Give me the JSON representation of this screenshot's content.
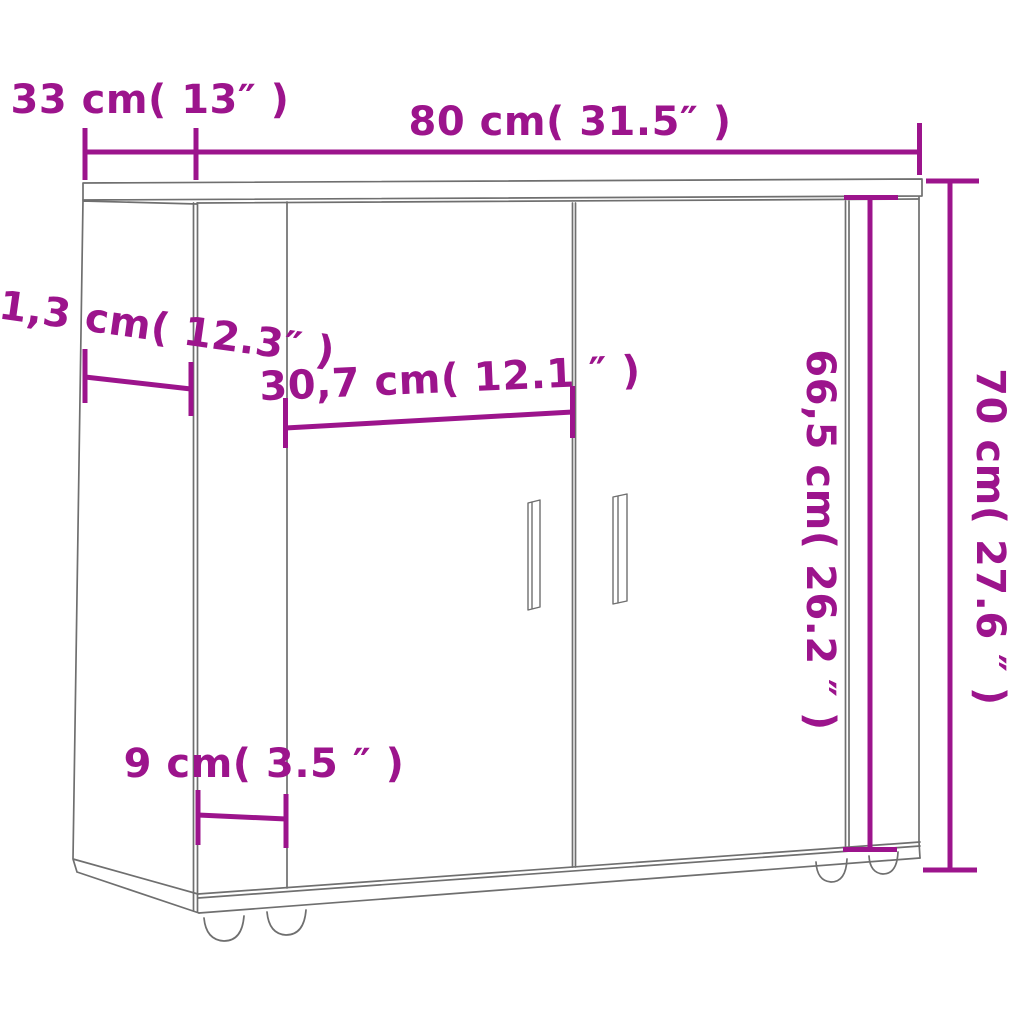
{
  "diagram": {
    "type": "furniture-dimension-diagram",
    "subject": "sideboard with two doors",
    "background": "#ffffff",
    "colors": {
      "dimension_annotations": "#9C148C",
      "drawing_lines": "#6f6f6f"
    },
    "labels": {
      "depth_top": "33 cm( 13″ )",
      "width_top": "80 cm( 31.5″ )",
      "depth_side": "31,3 cm( 12.3″ )",
      "door_width": "30,7 cm( 12.1 ″ )",
      "stile_width": "9 cm( 3.5 ″ )",
      "inner_height": "66,5 cm( 26.2 ″ )",
      "total_height": "70 cm( 27.6 ″ )"
    }
  }
}
